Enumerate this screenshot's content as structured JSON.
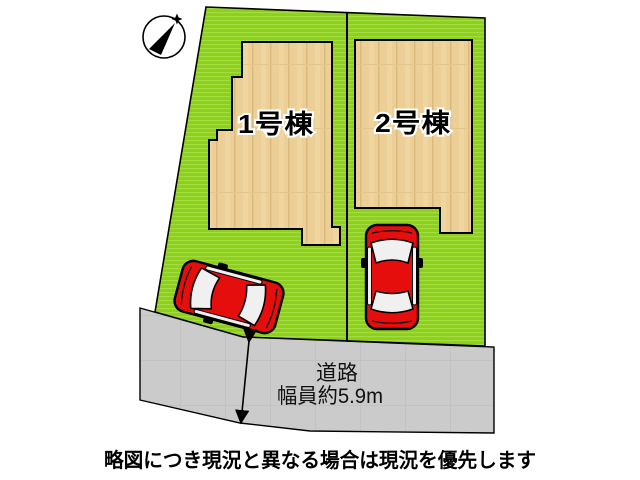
{
  "compass": {
    "marker": "north-star"
  },
  "plot": {
    "buildings": [
      {
        "label": "1号棟"
      },
      {
        "label": "2号棟"
      }
    ]
  },
  "road": {
    "name": "道路",
    "width_note": "幅員約5.9m"
  },
  "caption": "略図につき現況と異なる場合は現況を優先します",
  "colors": {
    "plot_green": "#8cd01b",
    "plot_green_stripe": "#a3dd41",
    "building_tan": "#eccf96",
    "building_plank_line": "#d9ba7c",
    "building_seam": "#e3c68b",
    "road_gray": "#cbcbcb",
    "road_seam": "#c2c2c2",
    "car_red": "#e60d0d",
    "car_window": "#f0f0f0",
    "outline": "#000000"
  }
}
